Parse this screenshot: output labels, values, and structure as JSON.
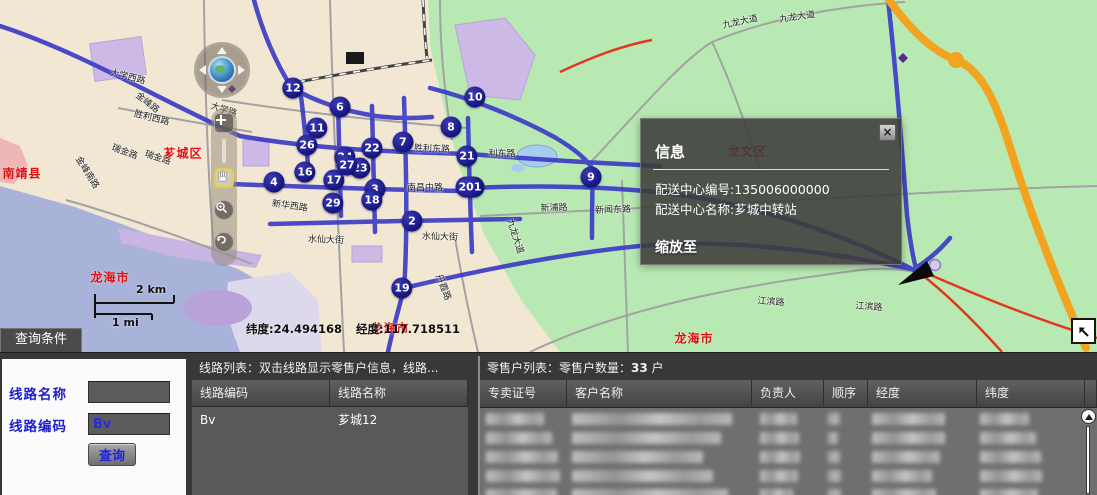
{
  "colors": {
    "map_urban": "#f2e7d2",
    "map_green": "#b9e9b2",
    "map_river": "#a9b3da",
    "route_blue": "#3c3cc6",
    "highway_orange": "#f2a31f",
    "marker_navy": "#15157e",
    "region_label_red": "#e01010",
    "panel_dark": "#3c3c3c",
    "accent_blue_text": "#2121cc"
  },
  "map": {
    "markers": [
      {
        "n": "12",
        "x": 293,
        "y": 88
      },
      {
        "n": "6",
        "x": 340,
        "y": 107
      },
      {
        "n": "11",
        "x": 317,
        "y": 128
      },
      {
        "n": "26",
        "x": 307,
        "y": 145
      },
      {
        "n": "22",
        "x": 372,
        "y": 148
      },
      {
        "n": "24",
        "x": 345,
        "y": 157
      },
      {
        "n": "7",
        "x": 403,
        "y": 142
      },
      {
        "n": "10",
        "x": 475,
        "y": 97
      },
      {
        "n": "8",
        "x": 451,
        "y": 127
      },
      {
        "n": "21",
        "x": 467,
        "y": 156
      },
      {
        "n": "16",
        "x": 305,
        "y": 172
      },
      {
        "n": "4",
        "x": 274,
        "y": 182
      },
      {
        "n": "23",
        "x": 360,
        "y": 168
      },
      {
        "n": "27",
        "x": 347,
        "y": 165
      },
      {
        "n": "17",
        "x": 334,
        "y": 180
      },
      {
        "n": "3",
        "x": 375,
        "y": 189
      },
      {
        "n": "29",
        "x": 333,
        "y": 203
      },
      {
        "n": "18",
        "x": 372,
        "y": 200
      },
      {
        "n": "201",
        "x": 470,
        "y": 187
      },
      {
        "n": "2",
        "x": 412,
        "y": 221
      },
      {
        "n": "9",
        "x": 591,
        "y": 177
      },
      {
        "n": "19",
        "x": 402,
        "y": 288
      }
    ],
    "road_labels": [
      {
        "t": "金峰路",
        "x": 148,
        "y": 102,
        "r": 38
      },
      {
        "t": "大学西路",
        "x": 128,
        "y": 76,
        "r": 14
      },
      {
        "t": "瑞金路",
        "x": 125,
        "y": 151,
        "r": 20
      },
      {
        "t": "瑞金路",
        "x": 158,
        "y": 157,
        "r": 18
      },
      {
        "t": "金峰南路",
        "x": 88,
        "y": 172,
        "r": 58
      },
      {
        "t": "大学路",
        "x": 224,
        "y": 109,
        "r": 18
      },
      {
        "t": "胜利西路",
        "x": 152,
        "y": 117,
        "r": 14
      },
      {
        "t": "新华西路",
        "x": 290,
        "y": 205,
        "r": 8
      },
      {
        "t": "水仙大街",
        "x": 326,
        "y": 239,
        "r": 2
      },
      {
        "t": "水仙大街",
        "x": 440,
        "y": 236,
        "r": 2
      },
      {
        "t": "南昌中路",
        "x": 425,
        "y": 187,
        "r": 0
      },
      {
        "t": "胜利东路",
        "x": 432,
        "y": 148,
        "r": 2
      },
      {
        "t": "利东路",
        "x": 502,
        "y": 153,
        "r": 0
      },
      {
        "t": "新浦路",
        "x": 554,
        "y": 207,
        "r": -2
      },
      {
        "t": "新闻东路",
        "x": 613,
        "y": 209,
        "r": -2
      },
      {
        "t": "九龙大道",
        "x": 740,
        "y": 21,
        "r": -12
      },
      {
        "t": "九龙大道",
        "x": 797,
        "y": 16,
        "r": -8
      },
      {
        "t": "九龙大道",
        "x": 516,
        "y": 236,
        "r": 72
      },
      {
        "t": "江滨路",
        "x": 771,
        "y": 301,
        "r": 4
      },
      {
        "t": "江滨路",
        "x": 869,
        "y": 306,
        "r": 4
      },
      {
        "t": "丹霞路",
        "x": 444,
        "y": 287,
        "r": 68
      }
    ],
    "region_labels": [
      {
        "t": "南靖县",
        "x": 22,
        "y": 173,
        "r": 0
      },
      {
        "t": "芗城区",
        "x": 183,
        "y": 153,
        "r": 0
      },
      {
        "t": "龙文区",
        "x": 747,
        "y": 151,
        "r": 0
      },
      {
        "t": "龙海市",
        "x": 110,
        "y": 277,
        "r": 0
      },
      {
        "t": "龙海市",
        "x": 390,
        "y": 328,
        "r": 0
      },
      {
        "t": "龙海市",
        "x": 694,
        "y": 338,
        "r": 0
      }
    ],
    "scale_km": "2 km",
    "scale_mi": "1 mi",
    "coord_lat": "纬度:24.494168",
    "coord_lng": "经度:117.718511"
  },
  "popup": {
    "title": "信息",
    "center_code_line": "配送中心编号:135006000000",
    "center_name_line": "配送中心名称:芗城中转站",
    "zoom_to_label": "缩放至",
    "close_label": "×"
  },
  "query_panel": {
    "tab_label": "查询条件",
    "route_name_label": "线路名称",
    "route_name_value": "",
    "route_code_label": "线路编码",
    "route_code_value": "Bv",
    "query_button_label": "查询"
  },
  "route_list": {
    "header": "线路列表：双击线路显示零售户信息，线路...",
    "columns": [
      "线路编码",
      "线路名称"
    ],
    "rows": [
      [
        "Bv",
        "芗城12"
      ]
    ]
  },
  "retailer_list": {
    "header_prefix": "零售户列表：零售户数量：",
    "count": "33",
    "header_suffix": " 户",
    "columns": [
      "专卖证号",
      "客户名称",
      "负责人",
      "顺序",
      "经度",
      "纬度"
    ],
    "redacted_row_count": 5
  }
}
